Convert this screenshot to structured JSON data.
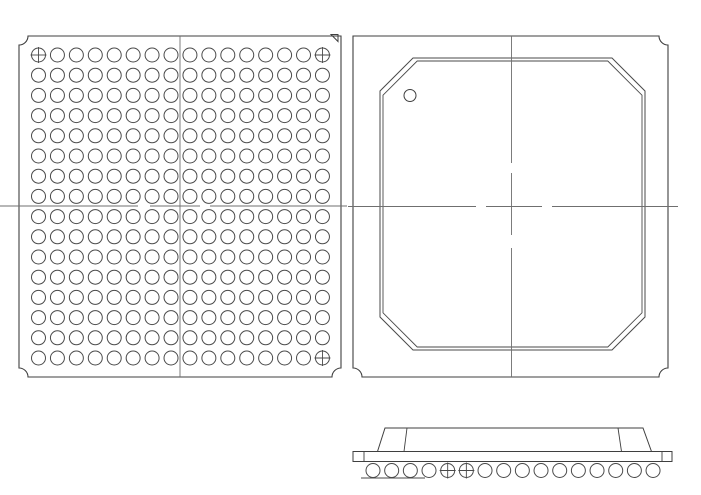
{
  "drawing_title_visible_text": "",
  "colors": {
    "background": "#ffffff",
    "outline": "#3f3f3f",
    "ball_stroke": "#4a4a4a",
    "lid_line": "#4a4a4a",
    "centerline": "#6f6f6f"
  },
  "bottom_view": {
    "icon": "bga-ball-grid-bottom-view",
    "outline": {
      "x1": 19,
      "y1": 36,
      "x2": 341,
      "y2": 377,
      "notch_r": 9,
      "notches": [
        "tl",
        "bl",
        "br"
      ]
    },
    "pin1_triangle": {
      "icon": "pin-a1-triangle-icon",
      "points": "331,34.5 338,34.5 338,41.5"
    },
    "centerline_v": {
      "x": 180,
      "y1": 36,
      "y2": 377,
      "dash": ""
    },
    "centerline_h": {
      "y": 206,
      "x1": 0,
      "x2": 347,
      "dash": "138 12 50 10 400"
    },
    "ball_grid": {
      "cols": 16,
      "rows": 16,
      "x0": 38.5,
      "y0": 55,
      "pitch_x": 18.93,
      "pitch_y": 20.2,
      "r": 7,
      "crosshair_cells": [
        [
          1,
          1
        ],
        [
          1,
          16
        ],
        [
          16,
          16
        ]
      ],
      "crosshair_icon": "datum-crosshair-icon"
    }
  },
  "top_view": {
    "icon": "bga-package-top-view",
    "outline": {
      "x1": 353,
      "y1": 36,
      "x2": 668,
      "y2": 377,
      "notch_r": 9,
      "notches": [
        "tr",
        "bl",
        "br"
      ]
    },
    "lid": {
      "x1": 380,
      "y1": 58,
      "x2": 645,
      "y2": 350,
      "chamfer": 33,
      "inner_inset": 3,
      "inner_chamfer": 34.2
    },
    "pin1_circle": {
      "icon": "pin-1-indicator-icon",
      "cx": 410,
      "cy": 95.5,
      "r": 6
    },
    "centerline_v": {
      "x": 511.5,
      "y1": 36,
      "y2": 377,
      "dash": "127 10 62 13 400"
    },
    "centerline_h": {
      "y": 206.5,
      "x1": 348,
      "x2": 678,
      "dash": "128 10 56 10 400"
    }
  },
  "side_view": {
    "icon": "bga-package-side-view",
    "substrate": {
      "x1": 353,
      "y1": 451.5,
      "x2": 672,
      "y2": 461.5,
      "tick_x1": 364,
      "tick_x2": 662
    },
    "lid": {
      "top_y": 428,
      "base_y": 451.5,
      "top_x1": 385,
      "top_x2": 643,
      "outer_x1": 377.5,
      "outer_x2": 651.5,
      "inner_lines": [
        [
          407,
          428,
          404,
          451.5
        ],
        [
          618,
          428,
          621.5,
          451.5
        ]
      ]
    },
    "balls": {
      "count": 16,
      "x0": 373,
      "pitch": 18.67,
      "cy": 470.5,
      "r": 7,
      "crosshair_indices": [
        5,
        6
      ]
    },
    "seating_ticks": {
      "y": 478,
      "segments": [
        [
          361,
          387
        ],
        [
          380,
          406
        ],
        [
          399,
          425
        ]
      ]
    }
  }
}
